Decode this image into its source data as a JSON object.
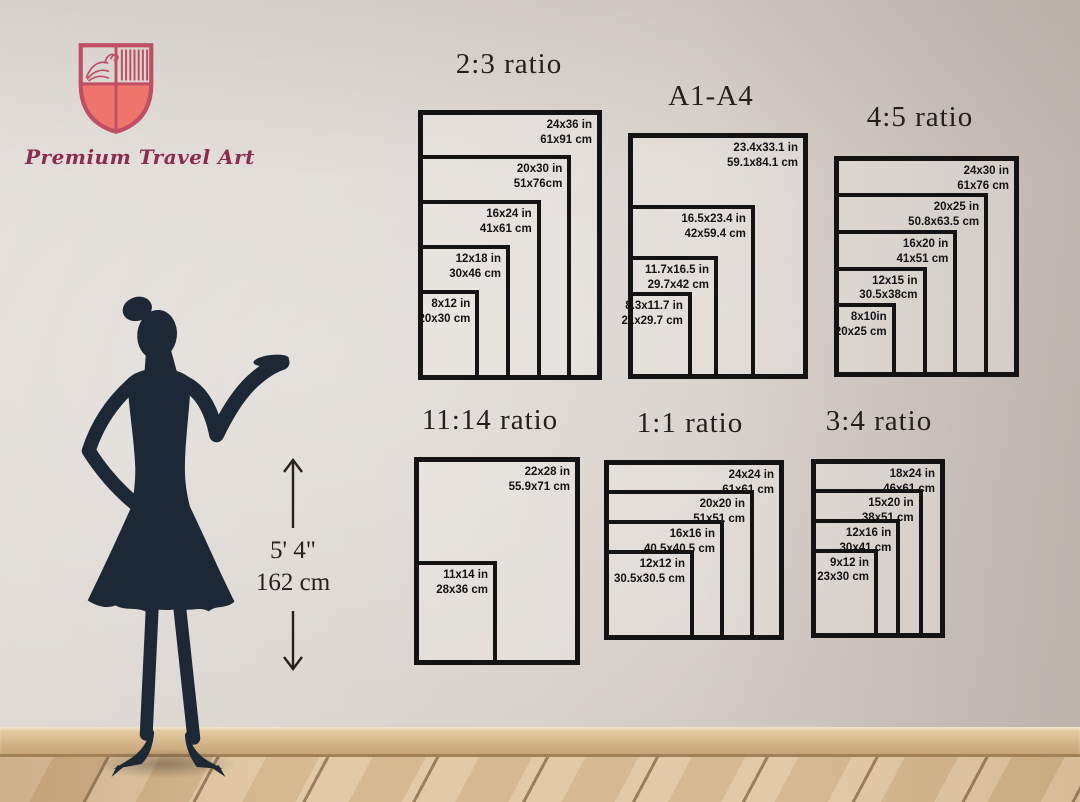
{
  "brand": {
    "name": "Premium Travel Art",
    "logo_icon": "shield-with-bird-and-stripes"
  },
  "height_indicator": {
    "imperial": "5' 4\"",
    "metric": "162 cm"
  },
  "charts": [
    {
      "id": "ratio-2-3",
      "title": "2:3 ratio",
      "sizes": [
        {
          "inches": [
            24,
            36
          ],
          "label_in": "24x36 in",
          "label_cm": "61x91 cm"
        },
        {
          "inches": [
            20,
            30
          ],
          "label_in": "20x30 in",
          "label_cm": "51x76cm"
        },
        {
          "inches": [
            16,
            24
          ],
          "label_in": "16x24 in",
          "label_cm": "41x61 cm"
        },
        {
          "inches": [
            12,
            18
          ],
          "label_in": "12x18 in",
          "label_cm": "30x46 cm"
        },
        {
          "inches": [
            8,
            12
          ],
          "label_in": "8x12 in",
          "label_cm": "20x30 cm"
        }
      ]
    },
    {
      "id": "a1-a4",
      "title": "A1-A4",
      "sizes": [
        {
          "inches": [
            23.4,
            33.1
          ],
          "label_in": "23.4x33.1 in",
          "label_cm": "59.1x84.1 cm"
        },
        {
          "inches": [
            16.5,
            23.4
          ],
          "label_in": "16.5x23.4 in",
          "label_cm": "42x59.4 cm"
        },
        {
          "inches": [
            11.7,
            16.5
          ],
          "label_in": "11.7x16.5 in",
          "label_cm": "29.7x42 cm"
        },
        {
          "inches": [
            8.3,
            11.7
          ],
          "label_in": "8.3x11.7 in",
          "label_cm": "21x29.7 cm"
        }
      ]
    },
    {
      "id": "ratio-4-5",
      "title": "4:5 ratio",
      "sizes": [
        {
          "inches": [
            24,
            30
          ],
          "label_in": "24x30 in",
          "label_cm": "61x76 cm"
        },
        {
          "inches": [
            20,
            25
          ],
          "label_in": "20x25 in",
          "label_cm": "50.8x63.5 cm"
        },
        {
          "inches": [
            16,
            20
          ],
          "label_in": "16x20 in",
          "label_cm": "41x51 cm"
        },
        {
          "inches": [
            12,
            15
          ],
          "label_in": "12x15 in",
          "label_cm": "30.5x38cm"
        },
        {
          "inches": [
            8,
            10
          ],
          "label_in": "8x10in",
          "label_cm": "20x25 cm"
        }
      ]
    },
    {
      "id": "ratio-11-14",
      "title": "11:14 ratio",
      "sizes": [
        {
          "inches": [
            22,
            28
          ],
          "label_in": "22x28 in",
          "label_cm": "55.9x71 cm"
        },
        {
          "inches": [
            11,
            14
          ],
          "label_in": "11x14 in",
          "label_cm": "28x36 cm"
        }
      ]
    },
    {
      "id": "ratio-1-1",
      "title": "1:1 ratio",
      "sizes": [
        {
          "inches": [
            24,
            24
          ],
          "label_in": "24x24 in",
          "label_cm": "61x61 cm"
        },
        {
          "inches": [
            20,
            20
          ],
          "label_in": "20x20 in",
          "label_cm": "51x51 cm"
        },
        {
          "inches": [
            16,
            16
          ],
          "label_in": "16x16 in",
          "label_cm": "40.5x40.5 cm"
        },
        {
          "inches": [
            12,
            12
          ],
          "label_in": "12x12 in",
          "label_cm": "30.5x30.5 cm"
        }
      ]
    },
    {
      "id": "ratio-3-4",
      "title": "3:4 ratio",
      "sizes": [
        {
          "inches": [
            18,
            24
          ],
          "label_in": "18x24 in",
          "label_cm": "46x61 cm"
        },
        {
          "inches": [
            15,
            20
          ],
          "label_in": "15x20 in",
          "label_cm": "38x51 cm"
        },
        {
          "inches": [
            12,
            16
          ],
          "label_in": "12x16 in",
          "label_cm": "30x41 cm"
        },
        {
          "inches": [
            9,
            12
          ],
          "label_in": "9x12 in",
          "label_cm": "23x30 cm"
        }
      ]
    }
  ],
  "colors": {
    "wall": "#d8d2cc",
    "frame_border": "#131313",
    "label_text": "#131313",
    "title_text": "#221f1c",
    "logo_outline": "#c04f66",
    "logo_fill": "#ee756b",
    "brand_text": "#8e2950",
    "silhouette": "#1c2836",
    "baseboard": "#d3b287",
    "floor": "#ddc199"
  }
}
